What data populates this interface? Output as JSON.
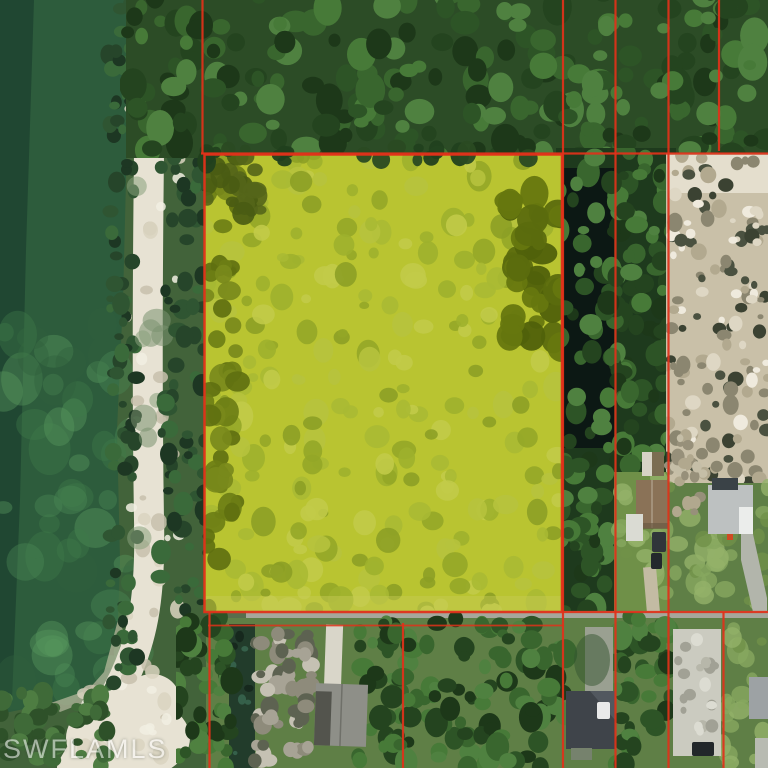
{
  "watermark": {
    "text": "SWFLAMLS"
  },
  "map": {
    "kind": "aerial-parcel-map",
    "colors": {
      "boundary_line": "#e0321a",
      "parcel_highlight": "#b9c431",
      "lake_water": "#2d5c3c",
      "pond_water": "#0c1814",
      "sand_road": "#e7e2d3",
      "forest_canopy": "#2c4c26",
      "cleared_soil": "#c9c0a8",
      "paved_road": "#94978d",
      "grass": "#5f7f46"
    }
  }
}
